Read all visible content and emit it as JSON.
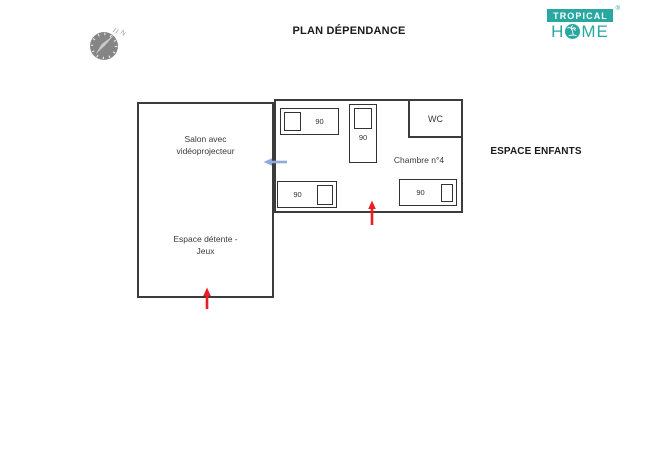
{
  "title": "PLAN DÉPENDANCE",
  "logo": {
    "brand_top": "TROPICAL",
    "registered_mark": "®",
    "brand_bottom_left": "H",
    "brand_bottom_right": "ME"
  },
  "compass": {
    "north_label": "N"
  },
  "plan": {
    "salon_line1": "Salon avec",
    "salon_line2": "vidéoprojecteur",
    "detente_line1": "Espace détente -",
    "detente_line2": "Jeux",
    "chambre_label": "Chambre n°4",
    "wc_label": "WC",
    "espace_enfants_label": "ESPACE ENFANTS",
    "beds": [
      {
        "size": "90",
        "position": "top-left",
        "pillow": "left"
      },
      {
        "size": "90",
        "position": "top-middle-vertical",
        "pillow": "top"
      },
      {
        "size": "90",
        "position": "bottom-left",
        "pillow": "right"
      },
      {
        "size": "90",
        "position": "bottom-right",
        "pillow": "right"
      }
    ]
  },
  "colors": {
    "wall": "#3c3c3c",
    "bed_outline": "#333333",
    "red_arrow": "#ee1c23",
    "blue_arrow": "#8faadc",
    "brand_teal": "#29a7a1",
    "compass_gray": "#858585"
  }
}
